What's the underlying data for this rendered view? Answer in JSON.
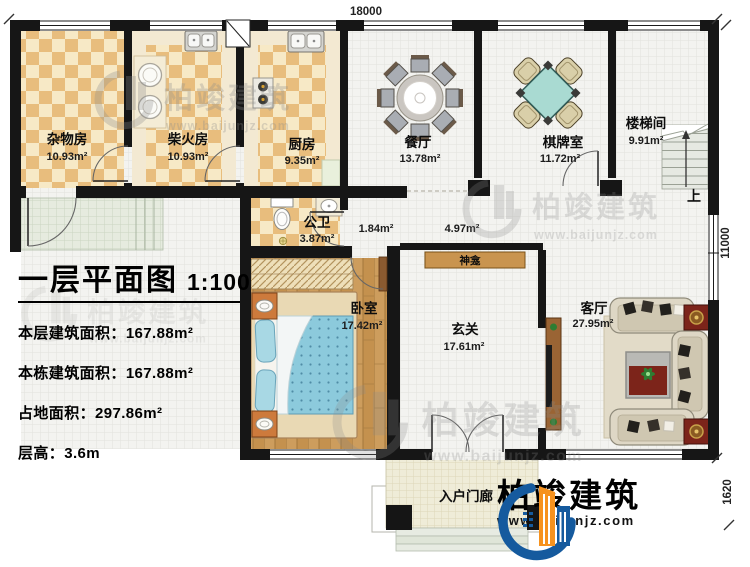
{
  "plan": {
    "title": "一层平面图",
    "scale": "1:100",
    "stats": [
      {
        "label": "本层建筑面积：",
        "value": "167.88m²"
      },
      {
        "label": "本栋建筑面积：",
        "value": "167.88m²"
      },
      {
        "label": "占地面积：",
        "value": "297.86m²"
      },
      {
        "label": "层高：",
        "value": "3.6m"
      }
    ]
  },
  "rooms": [
    {
      "name": "杂物房",
      "area": "10.93m²"
    },
    {
      "name": "柴火房",
      "area": "10.93m²"
    },
    {
      "name": "厨房",
      "area": "9.35m²"
    },
    {
      "name": "餐厅",
      "area": "13.78m²"
    },
    {
      "name": "棋牌室",
      "area": "11.72m²"
    },
    {
      "name": "楼梯间",
      "area": "9.91m²"
    },
    {
      "name": "公卫",
      "area": "3.87m²"
    },
    {
      "name": "卧室",
      "area": "17.42m²"
    },
    {
      "name": "玄关",
      "area": "17.61m²"
    },
    {
      "name": "客厅",
      "area": "27.95m²"
    },
    {
      "name": "入户门廊",
      "area": ""
    }
  ],
  "passages": {
    "hall_small": "1.84m²",
    "hall_main": "4.97m²"
  },
  "features": {
    "shrine": "神龛",
    "stairs_up": "上"
  },
  "dimensions": {
    "width": "18000",
    "height": "11000",
    "porch_depth": "1620"
  },
  "brand": {
    "name": "柏竣建筑",
    "url": "www.baijunjz.com"
  },
  "colors": {
    "wall": "#161616",
    "brand_blue": "#155a9e",
    "brand_orange": "#f6921e",
    "tile_dark": "#e8bd7d",
    "tile_light": "#f7e9c6",
    "wood": "#c4914e",
    "quilt_blue": "#8ccadc",
    "accent_red": "#7c241a"
  }
}
